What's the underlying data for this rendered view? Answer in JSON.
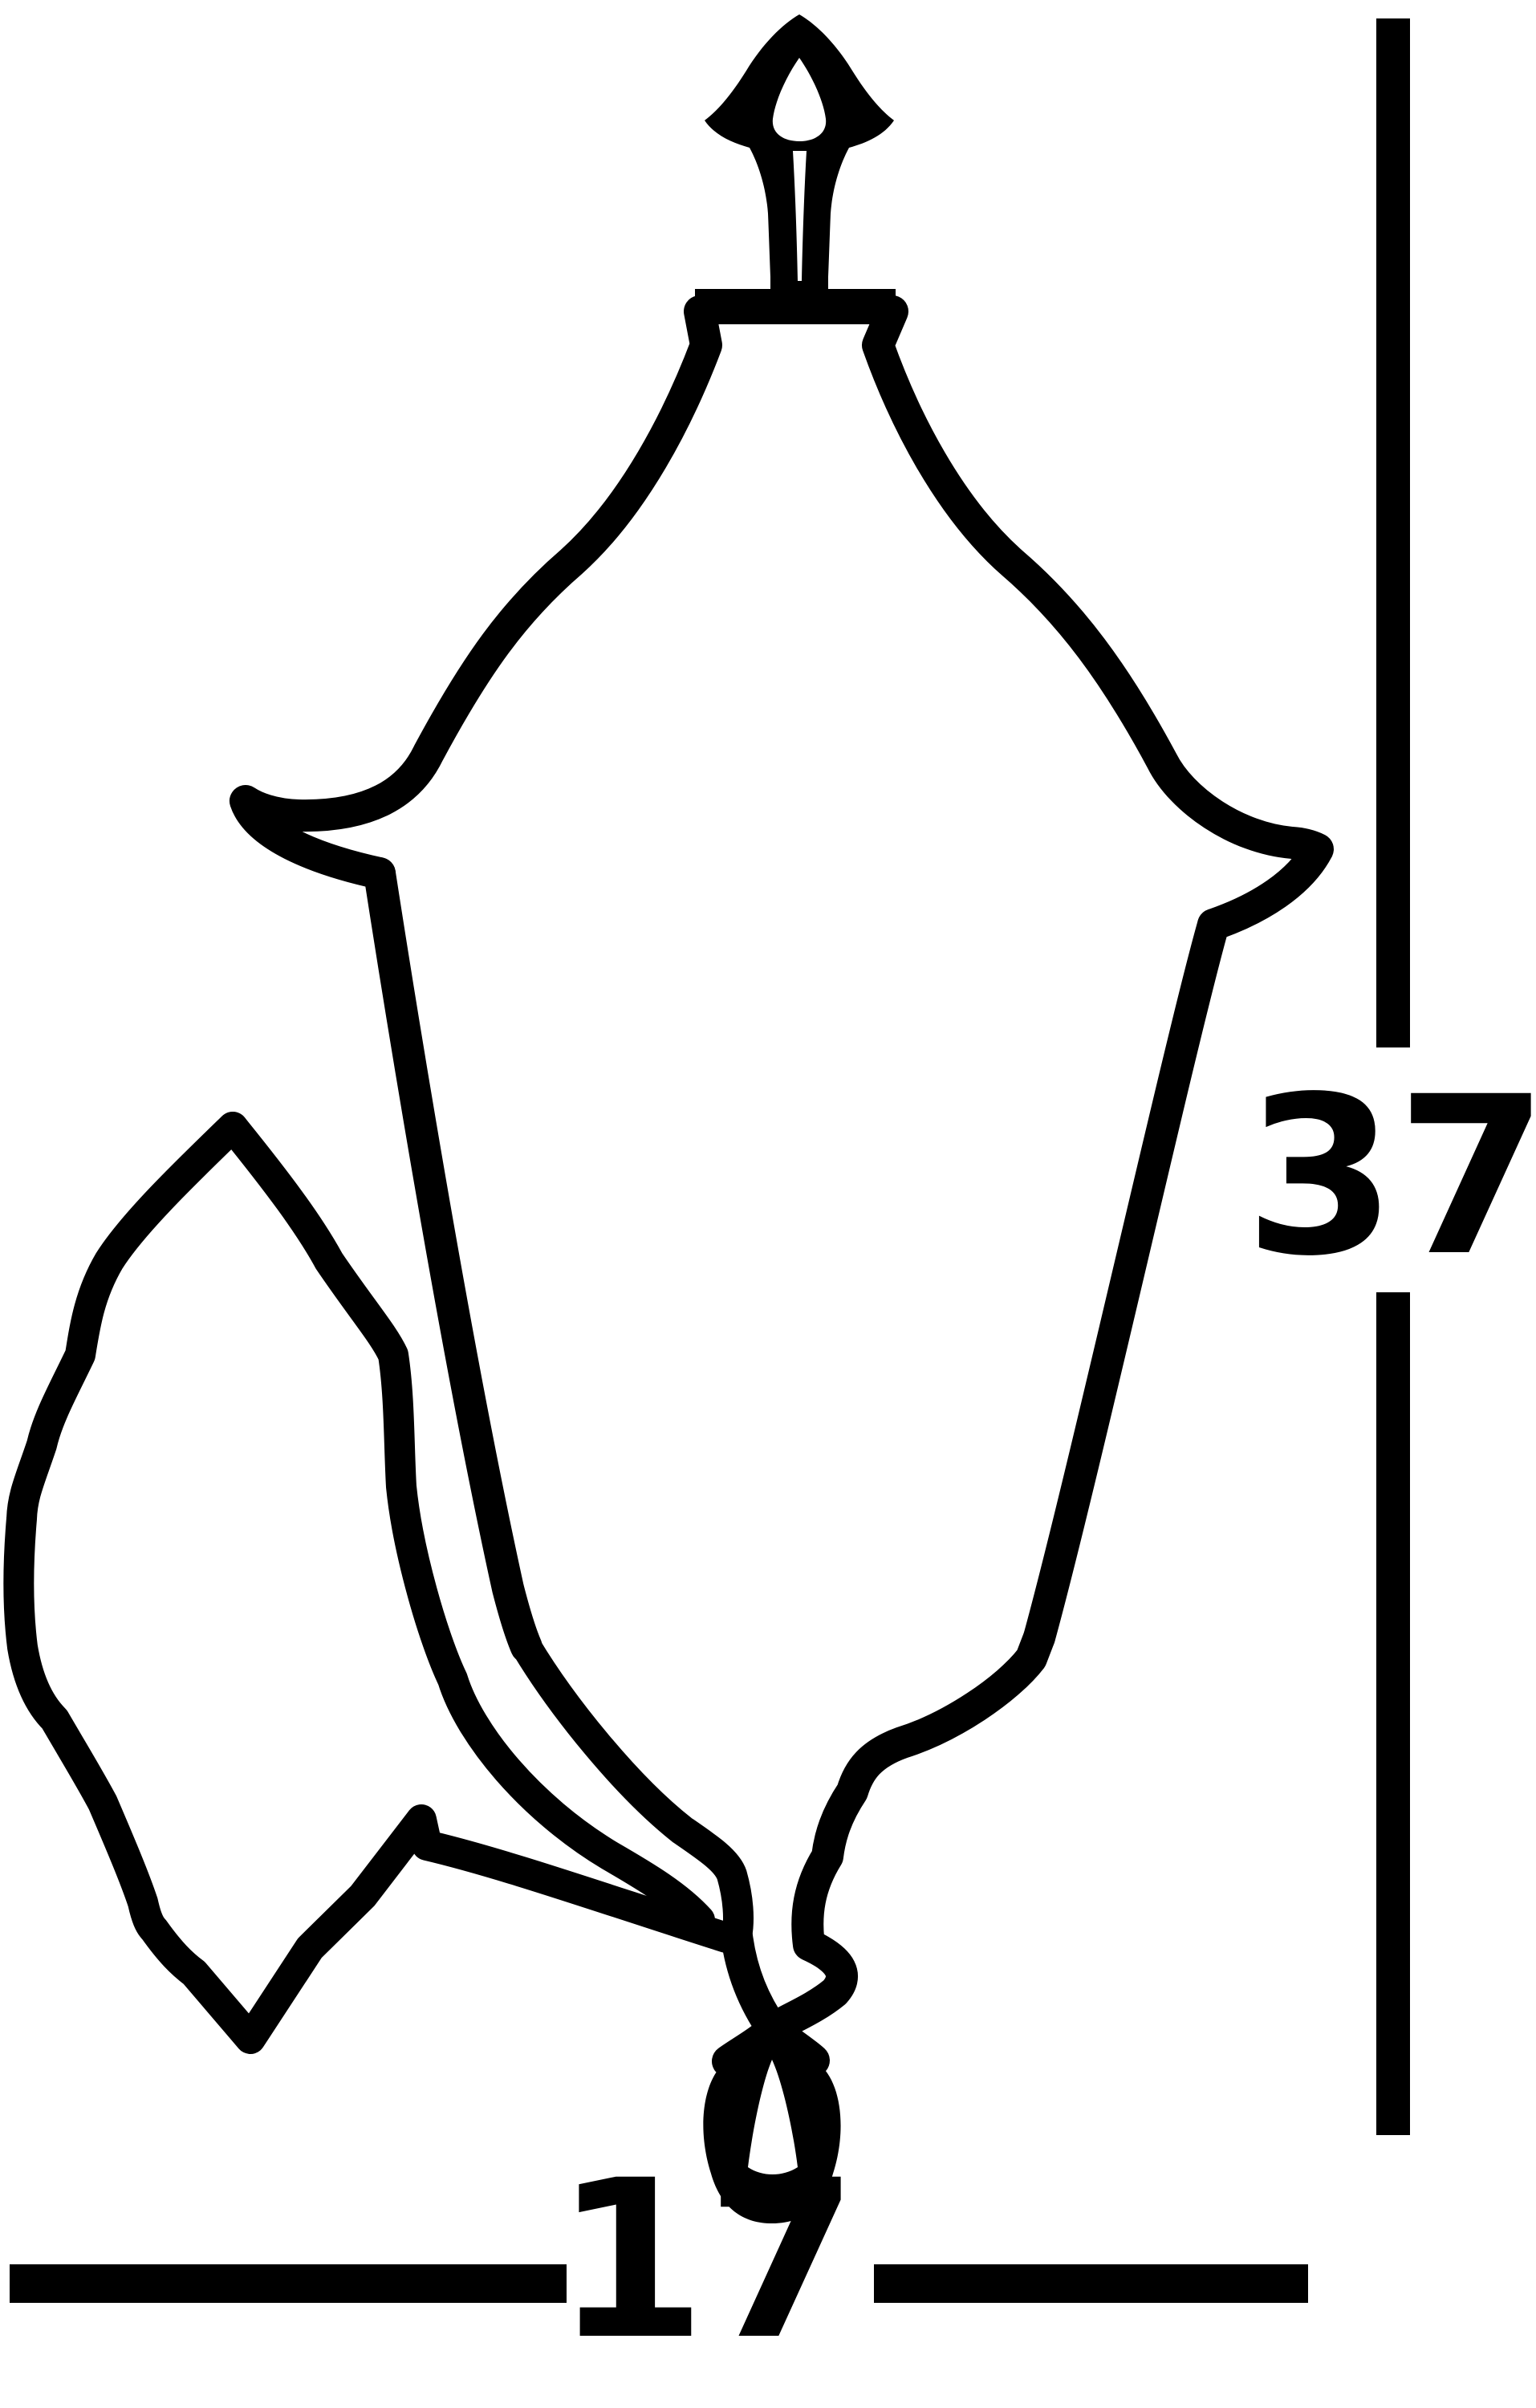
{
  "figure": {
    "description": "Outline dimension drawing of a wall lantern with scrolled wall bracket",
    "background_color": "#ffffff",
    "line_color": "#000000"
  },
  "dimensions": {
    "height": {
      "value": "37"
    },
    "width": {
      "value": "17"
    }
  }
}
